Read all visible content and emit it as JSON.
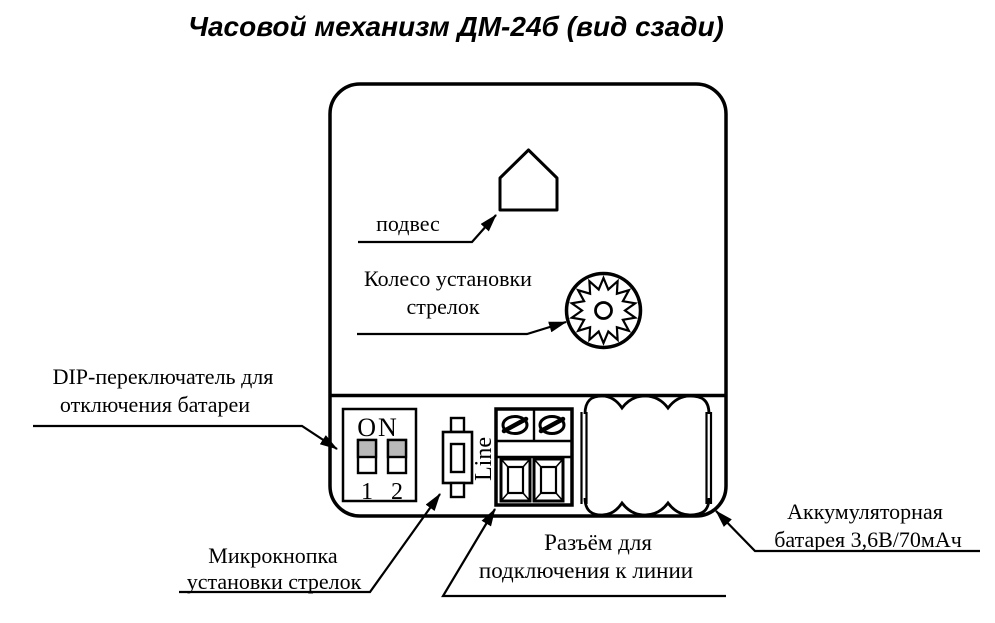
{
  "title": "Часовой механизм ДМ-24б (вид сзади)",
  "labels": {
    "hanger": "подвес",
    "wheel_line1": "Колесо установки",
    "wheel_line2": "стрелок",
    "dip_line1": "DIP-переключатель для",
    "dip_line2": "отключения батареи",
    "micro_line1": "Микрокнопка",
    "micro_line2": "установки стрелок",
    "connector_line1": "Разъём для",
    "connector_line2": "подключения к линии",
    "battery_line1": "Аккумуляторная",
    "battery_line2": "батарея 3,6В/70мАч"
  },
  "device": {
    "dip_switch": {
      "on_label": "ON",
      "switch1_label": "1",
      "switch2_label": "2"
    },
    "line_label": "Line"
  },
  "colors": {
    "ink": "#000000",
    "background": "#ffffff",
    "switch_slider": "#b9b9b9"
  }
}
